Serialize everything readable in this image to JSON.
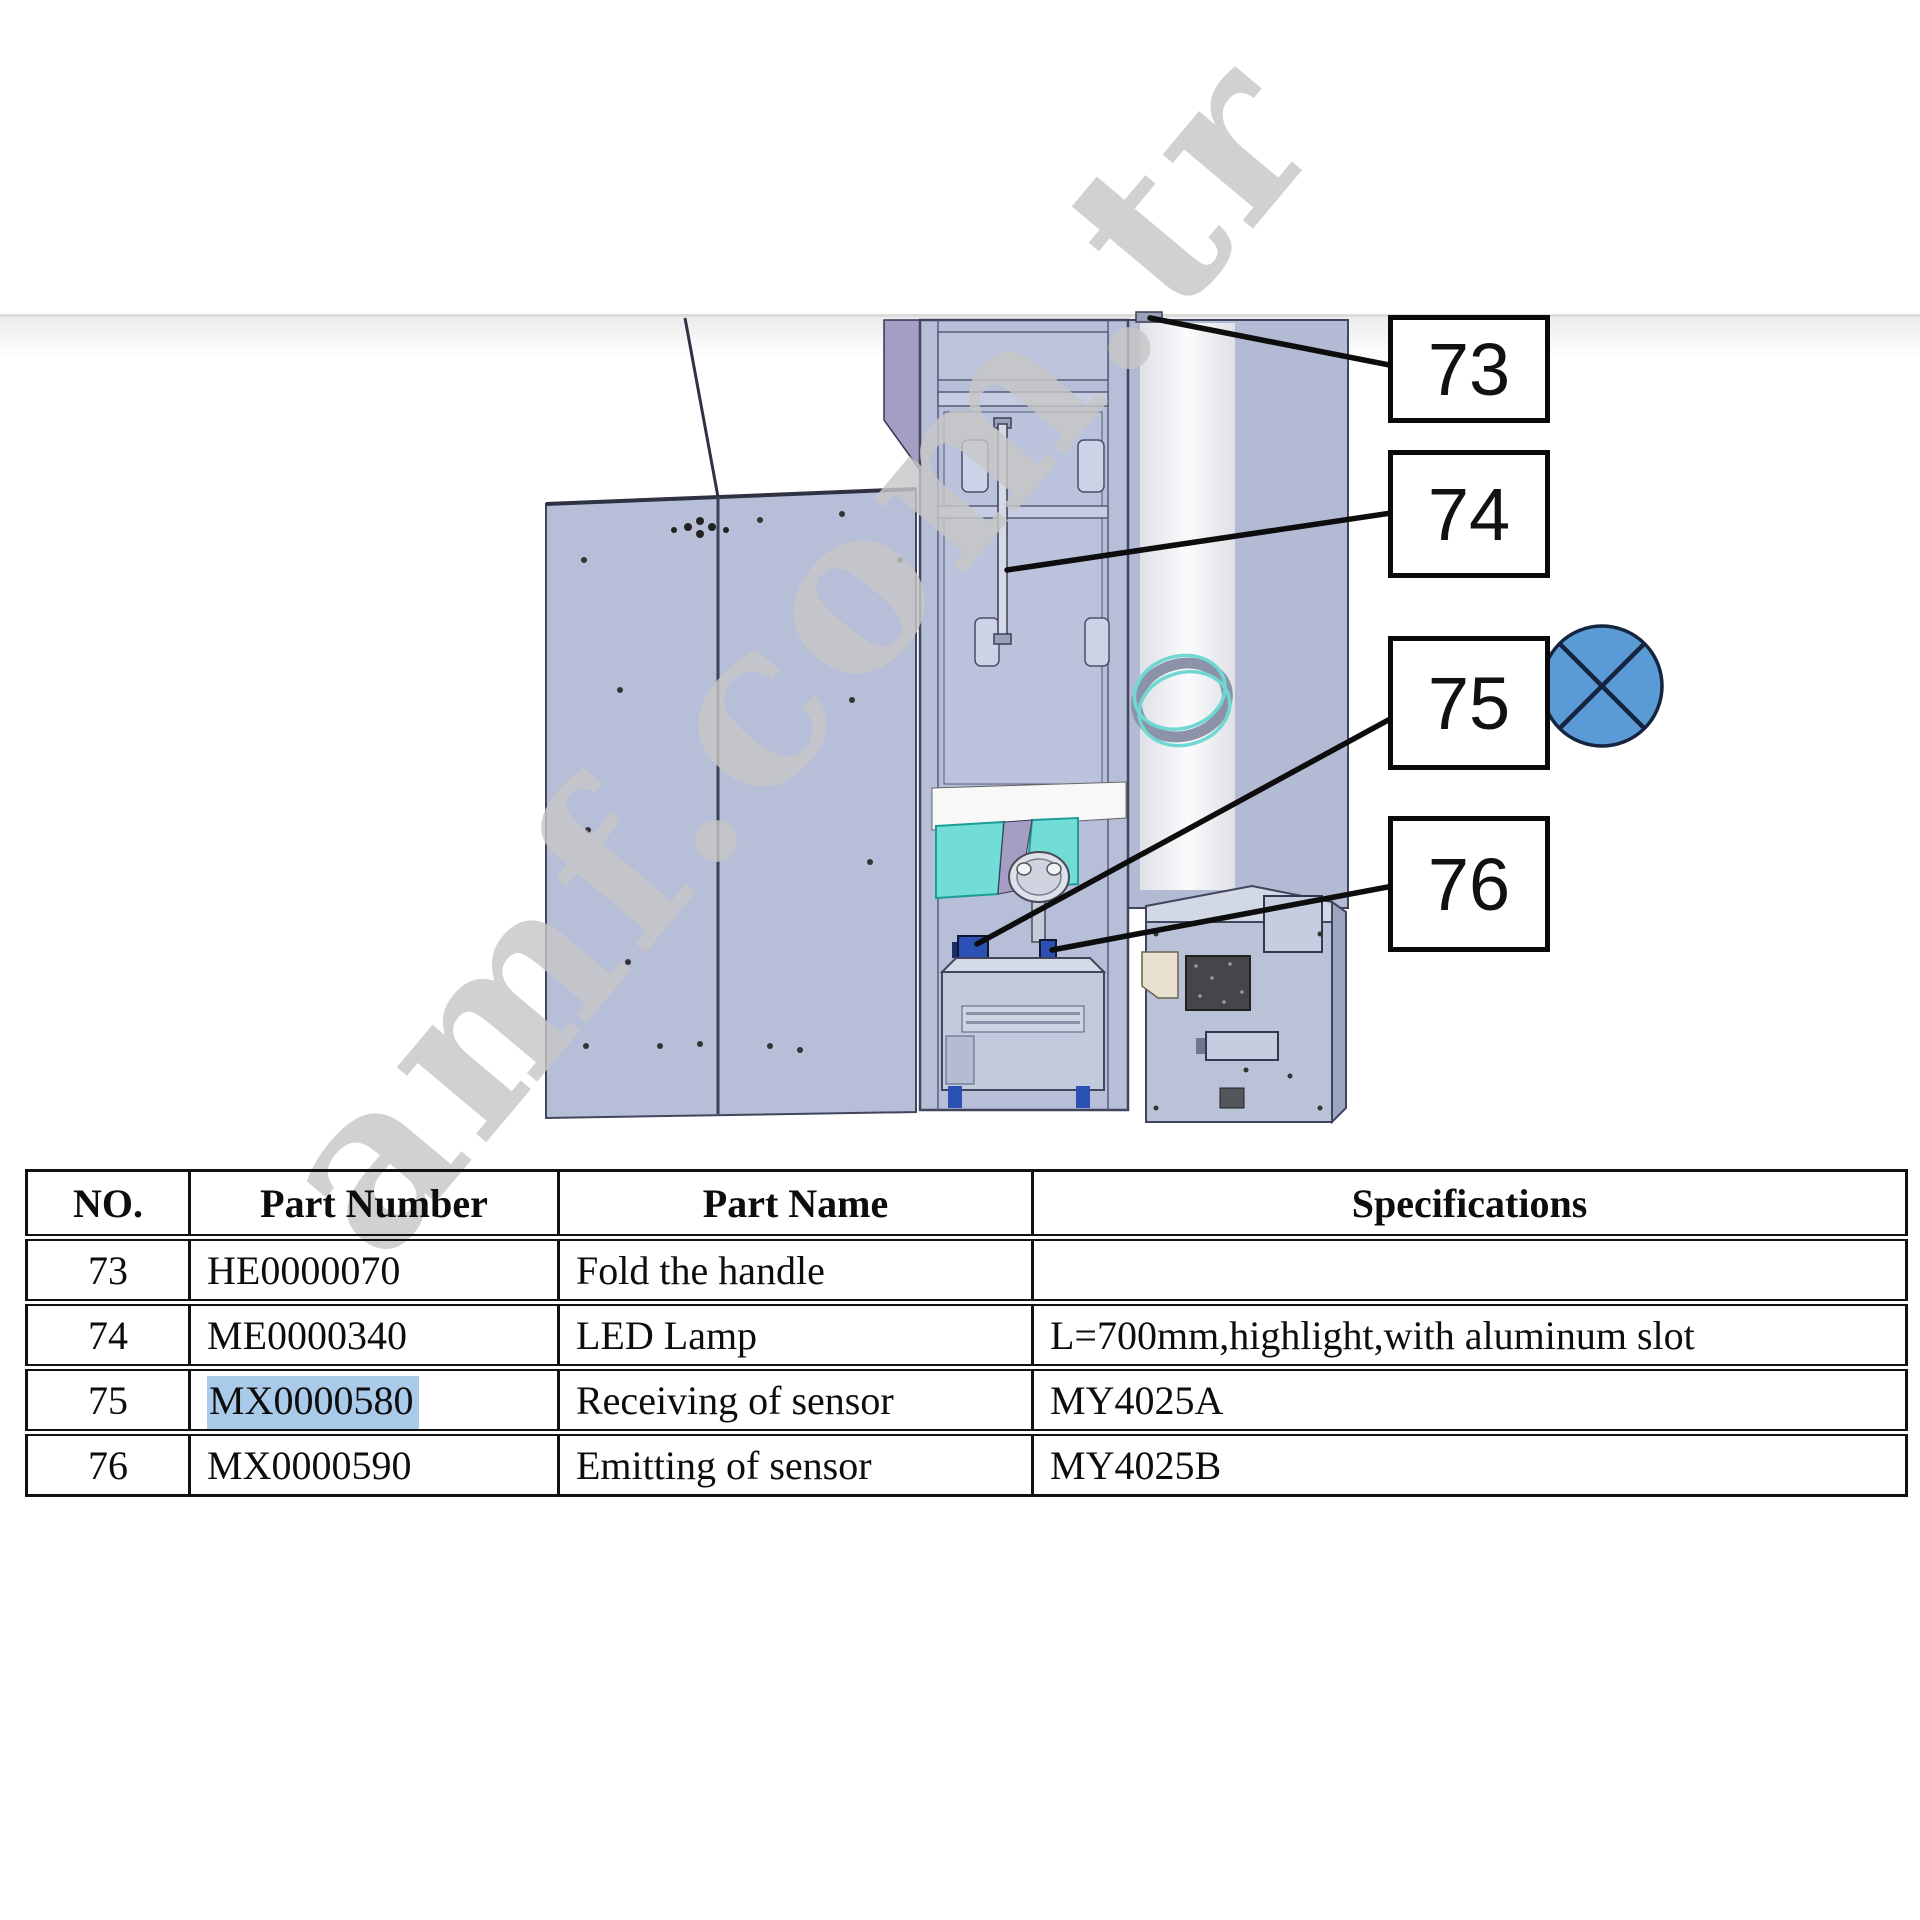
{
  "page": {
    "background": "#ffffff",
    "top_strip_color": "#ececec"
  },
  "watermark": {
    "text": "amf.com.tr",
    "color": "#c7c7c7"
  },
  "callouts": [
    {
      "label": "73"
    },
    {
      "label": "74"
    },
    {
      "label": "75"
    },
    {
      "label": "76"
    }
  ],
  "marker_icon": {
    "name": "crossed-circle-icon",
    "fill": "#5b9bd5",
    "stroke": "#15253f"
  },
  "diagram": {
    "description_icons": [
      "cabinet-diagram",
      "left-door-panel",
      "led-lamp-rod",
      "fold-handle",
      "receiving-sensor",
      "emitting-sensor",
      "machine-unit",
      "teal-ring"
    ],
    "panel_color": "#b6bed8",
    "roof_color": "#a59ec4",
    "glass_color": "#72dcd6",
    "sensor_color": "#2b51b4",
    "vent_color": "#45464a"
  },
  "table": {
    "headers": [
      "NO.",
      "Part Number",
      "Part Name",
      "Specifications"
    ],
    "highlight_color": "#a9cbe9",
    "rows": [
      {
        "no": "73",
        "part_number": "HE0000070",
        "part_name": "Fold the handle",
        "specifications": ""
      },
      {
        "no": "74",
        "part_number": "ME0000340",
        "part_name": "LED Lamp",
        "specifications": "L=700mm,highlight,with aluminum slot"
      },
      {
        "no": "75",
        "part_number": "MX0000580",
        "part_name": "Receiving of sensor",
        "specifications": "MY4025A"
      },
      {
        "no": "76",
        "part_number": "MX0000590",
        "part_name": "Emitting of sensor",
        "specifications": "MY4025B"
      }
    ]
  }
}
